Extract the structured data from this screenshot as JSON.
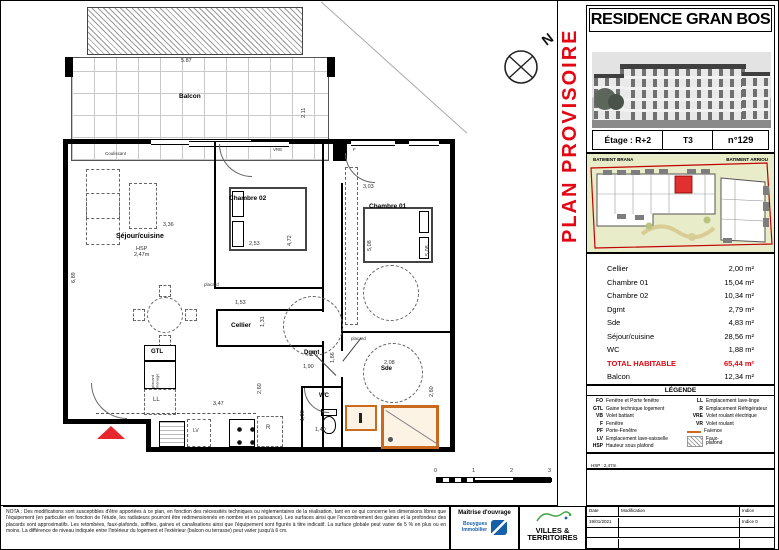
{
  "colors": {
    "accent_red": "#e30613",
    "entrance_red": "#e8262d",
    "faience_orange": "#c96a1f",
    "site_bg": "#e9ecc9",
    "unit_red": "#e03030"
  },
  "plan": {
    "balcony_label": "Balcon",
    "coulissant": "Coulissant",
    "north": "N",
    "rooms": {
      "sejour": "Séjour/cuisine",
      "hsp": "HSP\n2,47m",
      "chambre02": "Chambre 02",
      "chambre01": "Chambre 01",
      "cellier": "Cellier",
      "dgmt": "Dgmt",
      "wc": "WC",
      "sde": "Sde",
      "gtl": "GTL",
      "ll": "LL",
      "placard_menage": "placard\nménage",
      "placard_a": "placard",
      "placard_b": "placard",
      "fridge": "R",
      "lv": "LV",
      "vre": "VRE",
      "f": "F"
    },
    "dims": [
      "5.87",
      "2.11",
      "3,36",
      "6,89",
      "2,53",
      "4,72",
      "3,03",
      "5,08",
      "5,08",
      "1,53",
      "1,31",
      "1,90",
      "1,66",
      "2,60",
      "3,47",
      "1,38",
      "1,40",
      "2,08",
      "2,60"
    ],
    "scale": [
      "0",
      "1",
      "2",
      "3"
    ]
  },
  "panel": {
    "provisional": "PLAN PROVISOIRE",
    "title": "RESIDENCE GRAN BOS",
    "subtitle": "BRANA",
    "address": "Rue Doux Bos & avenue Jean Leon Laporte - 64600 Anglet",
    "etage": "Étage : R+2",
    "type": "T3",
    "lot": "n°129",
    "site": {
      "left": "BATIMENT BRANA",
      "right": "BATIMENT ARRIOU"
    },
    "areas": [
      {
        "n": "Cellier",
        "v": "2,00 m²"
      },
      {
        "n": "Chambre 01",
        "v": "15,04 m²"
      },
      {
        "n": "Chambre 02",
        "v": "10,34 m²"
      },
      {
        "n": "Dgmt",
        "v": "2,79 m²"
      },
      {
        "n": "Sde",
        "v": "4,83 m²"
      },
      {
        "n": "Séjour/cuisine",
        "v": "28,56 m²"
      },
      {
        "n": "WC",
        "v": "1,88 m²"
      }
    ],
    "total": {
      "n": "TOTAL HABITABLE",
      "v": "65,44 m²"
    },
    "balcon": {
      "n": "Balcon",
      "v": "12,34 m²"
    },
    "legend": {
      "title": "LÉGENDE",
      "left": [
        {
          "k": "FO",
          "v": "Fenêtre et Porte fenêtre"
        },
        {
          "k": "GTL",
          "v": "Gaine technique logement"
        },
        {
          "k": "VB",
          "v": "Volet battant"
        },
        {
          "k": "F",
          "v": "Fenêtre"
        },
        {
          "k": "PF",
          "v": "Porte-Fenêtre"
        },
        {
          "k": "LV",
          "v": "Emplacement lave-vaisselle"
        },
        {
          "k": "HSP",
          "v": "Hauteur sous plafond"
        }
      ],
      "right": [
        {
          "k": "LL",
          "v": "Emplacement lave-linge"
        },
        {
          "k": "R",
          "v": "Emplacement Réfrigérateur"
        },
        {
          "k": "VRE",
          "v": "Volet roulant électrique"
        },
        {
          "k": "VR",
          "v": "Volet roulant"
        },
        {
          "k": "",
          "v": "Faïence"
        },
        {
          "k": "",
          "v": "Faux-\nplafond"
        }
      ]
    },
    "hsp_note": "HSP : 2,47m",
    "revisions": {
      "headers": [
        "Date",
        "Modification",
        "Indice"
      ],
      "rows": [
        {
          "d": "19/01/2021",
          "m": "",
          "i": "Indice 0"
        },
        {
          "d": "",
          "m": "",
          "i": ""
        },
        {
          "d": "",
          "m": "",
          "i": ""
        }
      ]
    }
  },
  "footer": {
    "nota": "NOTA : Des modifications sont susceptibles d'être apportées à ce plan, en fonction des nécessités techniques ou réglementaires de la réalisation, tant en ce qui concerne les dimensions libres que l'équipement (en particulier en fonction de l'étude, les radiateurs pourront être redimensionnés en nombre et en puissance). Les surfaces ainsi que l'encombrement des gaines et la profondeur des placards sont approximatifs. Les retombées, faux-plafonds, soffites, gaines et canalisations ainsi que l'équipement sont figurés à titre indicatif. La surface globale peut varier de 5 % en plus ou en moins. La différence de niveau indiquée entre l'intérieur du logement et l'extérieur (balcon ou terrasse) peut varier jusqu'à 6 cm.",
    "moa_title": "Maîtrise d'ouvrage",
    "moa_name": "Bouygues\nImmobilier",
    "vt1": "VILLES &",
    "vt2": "TERRITOIRES"
  }
}
